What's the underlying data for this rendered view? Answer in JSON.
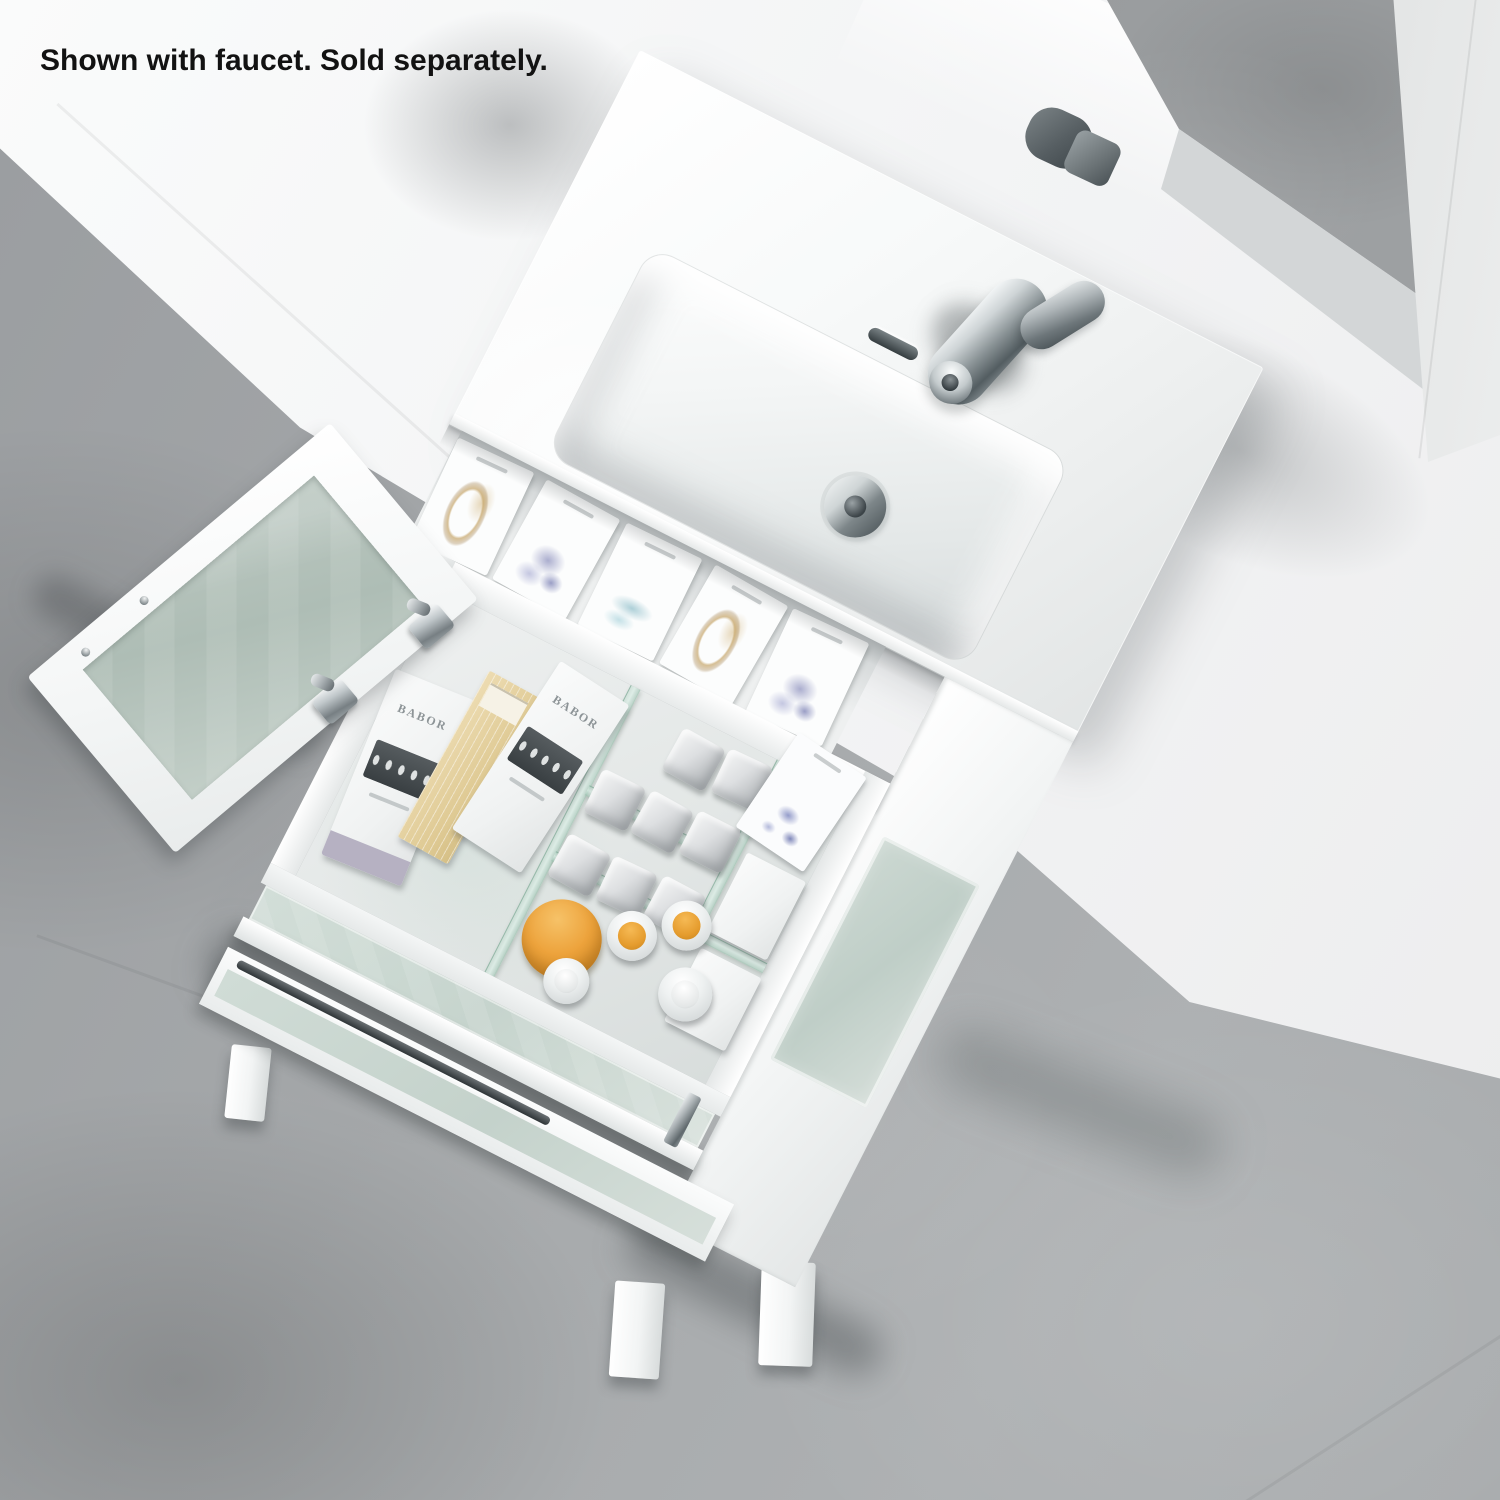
{
  "caption": "Shown with faucet. Sold separately.",
  "scene": {
    "subject": "Overhead product photo of a white freestanding bathroom vanity with integrated-sink countertop, open frosted-glass door and an open drawer organized with toiletries, on a gray stone floor",
    "wall_color": "#f3f4f5",
    "floor": {
      "material": "gray concrete tile",
      "base_color": "#a6a9ab"
    },
    "mirror": {
      "frame_color": "#f2f3f3",
      "reflects": "floor, countertop and back of faucet"
    },
    "countertop": {
      "color": "#f7f9f9",
      "basin": "rectangular integrated sink",
      "drain_finish": "polished chrome",
      "overflow_slot": true
    },
    "faucet": {
      "style": "single-handle deck-mount",
      "finish": "polished chrome",
      "sold_separately": true
    },
    "cabinet": {
      "finish": "glossy white",
      "door": {
        "state": "open",
        "panel": "frosted glass",
        "hinge_count": 2,
        "hinge_finish": "chrome",
        "screw_count": 2
      },
      "handles": {
        "style": "slim bar",
        "finish": "chrome"
      },
      "legs_visible": 3
    },
    "drawer": {
      "state": "open",
      "front_panel": "frosted glass",
      "dividers": "glass",
      "contents": {
        "brand_label": "BABOR",
        "ampoule_boxes": 3,
        "ampoules_per_window": 5,
        "box_colors": [
          "white with lavender edge",
          "tan",
          "white"
        ],
        "square_gray_jars": 8,
        "bottles_with_orange_caps": 2,
        "white_capped_bottles": 2,
        "orange_jars": 1,
        "display_cards": 6
      }
    }
  }
}
